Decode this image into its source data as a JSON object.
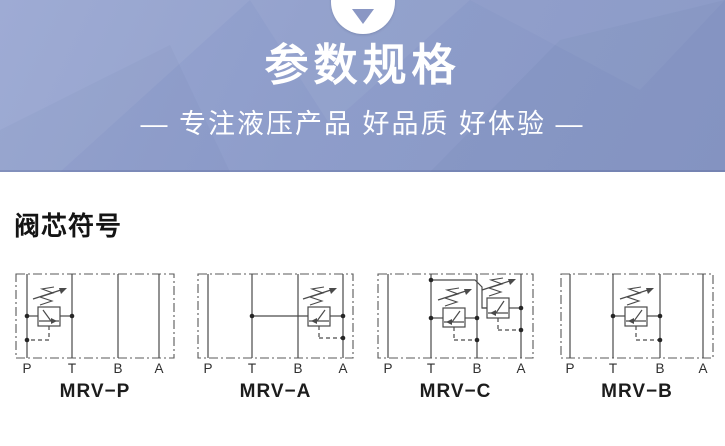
{
  "banner": {
    "title": "参数规格",
    "subtitle": "— 专注液压产品 好品质 好体验 —",
    "background_color": "#8e9dca",
    "text_color": "#ffffff",
    "indicator_icon": "triangle-down-icon"
  },
  "section": {
    "heading": "阀芯符号"
  },
  "diagram_style": {
    "line_color": "#4a4a4a",
    "dot_color": "#262626",
    "label_color": "#2e2e2e",
    "border_dash": "9 3 2 3",
    "pilot_dash": "4 3"
  },
  "diagrams": [
    {
      "label": "MRV−P",
      "left": 14,
      "width": 162,
      "box": {
        "x1": 2,
        "y1": 2,
        "x2": 160,
        "y2": 86
      },
      "ports": [
        {
          "label": "P",
          "x": 13
        },
        {
          "label": "T",
          "x": 58
        },
        {
          "label": "B",
          "x": 104
        },
        {
          "label": "A",
          "x": 145
        }
      ],
      "routes": [],
      "valves": [
        {
          "square": {
            "x": 24,
            "y": 35,
            "w": 22,
            "h": 19
          },
          "line_y": 44,
          "left_x": 13,
          "right_x": 58,
          "arrow": "right",
          "pilot": {
            "x": 35,
            "y_top": 54,
            "y_bottom": 68,
            "to_x": 13
          },
          "dots": [
            [
              13,
              44
            ],
            [
              58,
              44
            ],
            [
              13,
              68
            ]
          ]
        }
      ]
    },
    {
      "label": "MRV−A",
      "left": 196,
      "width": 159,
      "box": {
        "x1": 2,
        "y1": 2,
        "x2": 157,
        "y2": 86
      },
      "ports": [
        {
          "label": "P",
          "x": 12
        },
        {
          "label": "T",
          "x": 56
        },
        {
          "label": "B",
          "x": 102
        },
        {
          "label": "A",
          "x": 147
        }
      ],
      "routes": [],
      "valves": [
        {
          "square": {
            "x": 112,
            "y": 35,
            "w": 22,
            "h": 19
          },
          "line_y": 44,
          "left_x": 56,
          "right_x": 147,
          "arrow": "left",
          "pilot": {
            "x": 123,
            "y_top": 54,
            "y_bottom": 66,
            "to_x": 147
          },
          "dots": [
            [
              56,
              44
            ],
            [
              147,
              44
            ],
            [
              147,
              66
            ]
          ]
        }
      ]
    },
    {
      "label": "MRV−C",
      "left": 376,
      "width": 159,
      "box": {
        "x1": 2,
        "y1": 2,
        "x2": 157,
        "y2": 86
      },
      "ports": [
        {
          "label": "P",
          "x": 12
        },
        {
          "label": "T",
          "x": 55
        },
        {
          "label": "B",
          "x": 101
        },
        {
          "label": "A",
          "x": 145
        }
      ],
      "routes": [
        [
          [
            55,
            8
          ],
          [
            99,
            8
          ],
          [
            106,
            15
          ],
          [
            106,
            36
          ],
          [
            111,
            36
          ]
        ]
      ],
      "valves": [
        {
          "square": {
            "x": 67,
            "y": 36,
            "w": 22,
            "h": 19
          },
          "line_y": 46,
          "left_x": 55,
          "right_x": 101,
          "arrow": "left",
          "pilot": {
            "x": 78,
            "y_top": 55,
            "y_bottom": 68,
            "to_x": 101
          },
          "dots": [
            [
              55,
              46
            ],
            [
              101,
              46
            ],
            [
              101,
              68
            ],
            [
              55,
              8
            ]
          ]
        },
        {
          "square": {
            "x": 111,
            "y": 26,
            "w": 22,
            "h": 20
          },
          "line_y": 36,
          "left_x": 106,
          "right_x": 145,
          "arrow": "left",
          "pilot": {
            "x": 122,
            "y_top": 46,
            "y_bottom": 58,
            "to_x": 145
          },
          "dots": [
            [
              145,
              36
            ],
            [
              145,
              58
            ]
          ]
        }
      ]
    },
    {
      "label": "MRV−B",
      "left": 559,
      "width": 156,
      "box": {
        "x1": 2,
        "y1": 2,
        "x2": 154,
        "y2": 86
      },
      "ports": [
        {
          "label": "P",
          "x": 11
        },
        {
          "label": "T",
          "x": 54
        },
        {
          "label": "B",
          "x": 101
        },
        {
          "label": "A",
          "x": 144
        }
      ],
      "routes": [],
      "valves": [
        {
          "square": {
            "x": 66,
            "y": 35,
            "w": 22,
            "h": 19
          },
          "line_y": 44,
          "left_x": 54,
          "right_x": 101,
          "arrow": "left",
          "pilot": {
            "x": 77,
            "y_top": 54,
            "y_bottom": 68,
            "to_x": 101
          },
          "dots": [
            [
              54,
              44
            ],
            [
              101,
              44
            ],
            [
              101,
              68
            ]
          ]
        }
      ]
    }
  ]
}
